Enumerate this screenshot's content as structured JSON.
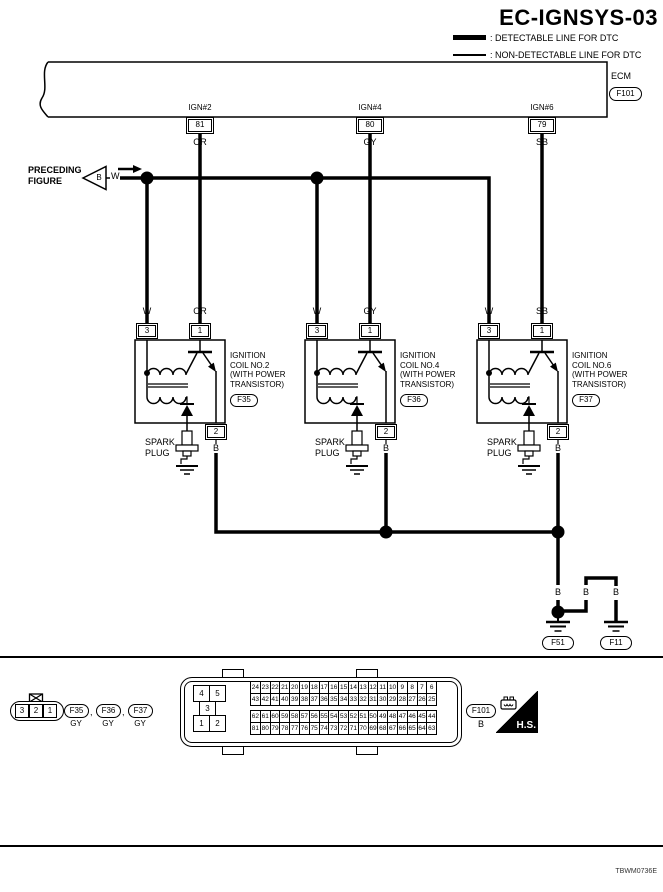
{
  "title": "EC-IGNSYS-03",
  "legend": {
    "detectable": ": DETECTABLE LINE FOR DTC",
    "non_detectable": ": NON-DETECTABLE LINE FOR DTC"
  },
  "ecm": {
    "label": "ECM",
    "connector": "F101",
    "pins": [
      {
        "signal": "IGN#2",
        "pin": "81",
        "wire": "OR"
      },
      {
        "signal": "IGN#4",
        "pin": "80",
        "wire": "GY"
      },
      {
        "signal": "IGN#6",
        "pin": "79",
        "wire": "SB"
      }
    ]
  },
  "preceding_figure": {
    "label_line1": "PRECEDING",
    "label_line2": "FIGURE",
    "tag": "B",
    "wire": "W"
  },
  "coils": [
    {
      "line1": "IGNITION",
      "line2": "COIL NO.2",
      "line3": "(WITH POWER",
      "line4": "TRANSISTOR)",
      "connector": "F35",
      "pin_supply": "3",
      "pin_signal": "1",
      "pin_ground": "2",
      "wire_supply": "W",
      "wire_signal": "OR",
      "wire_ground": "B",
      "spark_line1": "SPARK",
      "spark_line2": "PLUG"
    },
    {
      "line1": "IGNITION",
      "line2": "COIL NO.4",
      "line3": "(WITH POWER",
      "line4": "TRANSISTOR)",
      "connector": "F36",
      "pin_supply": "3",
      "pin_signal": "1",
      "pin_ground": "2",
      "wire_supply": "W",
      "wire_signal": "GY",
      "wire_ground": "B",
      "spark_line1": "SPARK",
      "spark_line2": "PLUG"
    },
    {
      "line1": "IGNITION",
      "line2": "COIL NO.6",
      "line3": "(WITH POWER",
      "line4": "TRANSISTOR)",
      "connector": "F37",
      "pin_supply": "3",
      "pin_signal": "1",
      "pin_ground": "2",
      "wire_supply": "W",
      "wire_signal": "SB",
      "wire_ground": "B",
      "spark_line1": "SPARK",
      "spark_line2": "PLUG"
    }
  ],
  "grounds": {
    "labels": [
      "B",
      "B",
      "B"
    ],
    "left": "F51",
    "right": "F11"
  },
  "footer": {
    "coil_connector": {
      "pins": [
        "3",
        "2",
        "1"
      ],
      "ids": [
        "F35",
        "F36",
        "F37"
      ],
      "color": "GY",
      "separator": ","
    },
    "ecm_connector": {
      "id": "F101",
      "color": "B",
      "left_pins": {
        "r1c1": "4",
        "r1c2": "5",
        "r2": "3",
        "r3c1": "1",
        "r3c2": "2"
      },
      "rows": [
        [
          24,
          23,
          22,
          21,
          20,
          19,
          18,
          17,
          16,
          15,
          14,
          13,
          12,
          11,
          10,
          9,
          8,
          7,
          6
        ],
        [
          43,
          42,
          41,
          40,
          39,
          38,
          37,
          36,
          35,
          34,
          33,
          32,
          31,
          30,
          29,
          28,
          27,
          26,
          25
        ],
        [
          62,
          61,
          60,
          59,
          58,
          57,
          56,
          55,
          54,
          53,
          52,
          51,
          50,
          49,
          48,
          47,
          46,
          45,
          44
        ],
        [
          81,
          80,
          79,
          78,
          77,
          76,
          75,
          74,
          73,
          72,
          71,
          70,
          69,
          68,
          67,
          66,
          65,
          64,
          63
        ]
      ]
    },
    "hs_label": "H.S."
  },
  "figure_code": "TBWM0736E"
}
